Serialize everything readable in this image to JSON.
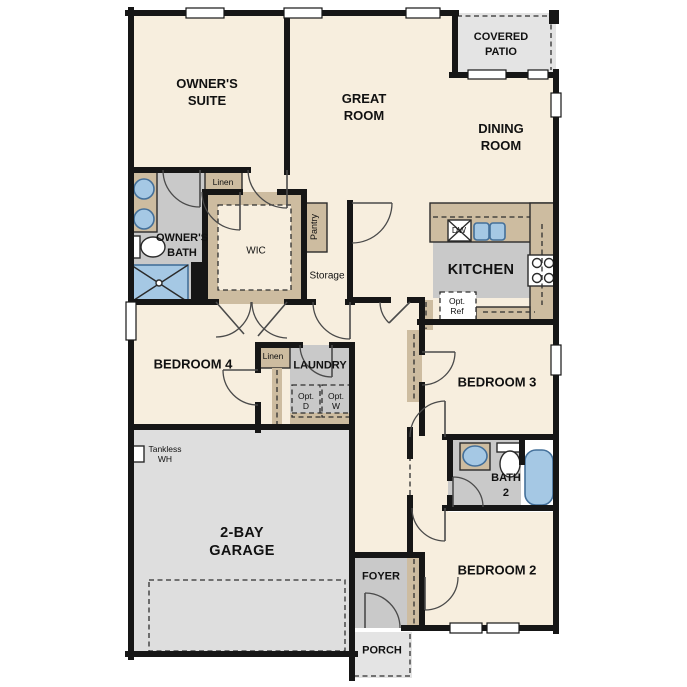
{
  "plan": {
    "labels": {
      "owners_suite": "OWNER'S\nSUITE",
      "great_room": "GREAT\nROOM",
      "covered_patio": "COVERED\nPATIO",
      "dining_room": "DINING\nROOM",
      "owners_bath": "OWNER'S\nBATH",
      "linen_upper": "Linen",
      "wic": "WIC",
      "pantry": "Pantry",
      "storage": "Storage",
      "kitchen": "KITCHEN",
      "dishwasher": "DW",
      "opt_ref": "Opt.\nRef",
      "bedroom4": "BEDROOM 4",
      "linen_hall": "Linen",
      "laundry": "LAUNDRY",
      "opt_dryer": "Opt.\nD",
      "opt_washer": "Opt.\nW",
      "tankless_wh": "Tankless\nWH",
      "garage": "2-BAY\nGARAGE",
      "bedroom3": "BEDROOM 3",
      "bath2": "BATH\n2",
      "bedroom2": "BEDROOM 2",
      "foyer": "FOYER",
      "porch": "PORCH"
    },
    "colors": {
      "wall": "#161616",
      "floor-cream": "#f7eede",
      "cabinet-tan": "#cdbca0",
      "room-gray": "#c9c9c9",
      "garage-gray": "#dedede",
      "patio-gray": "#e4e4e4",
      "fixture-blue": "#a5c8e4",
      "fixture-blue-dark": "#44709a"
    }
  }
}
